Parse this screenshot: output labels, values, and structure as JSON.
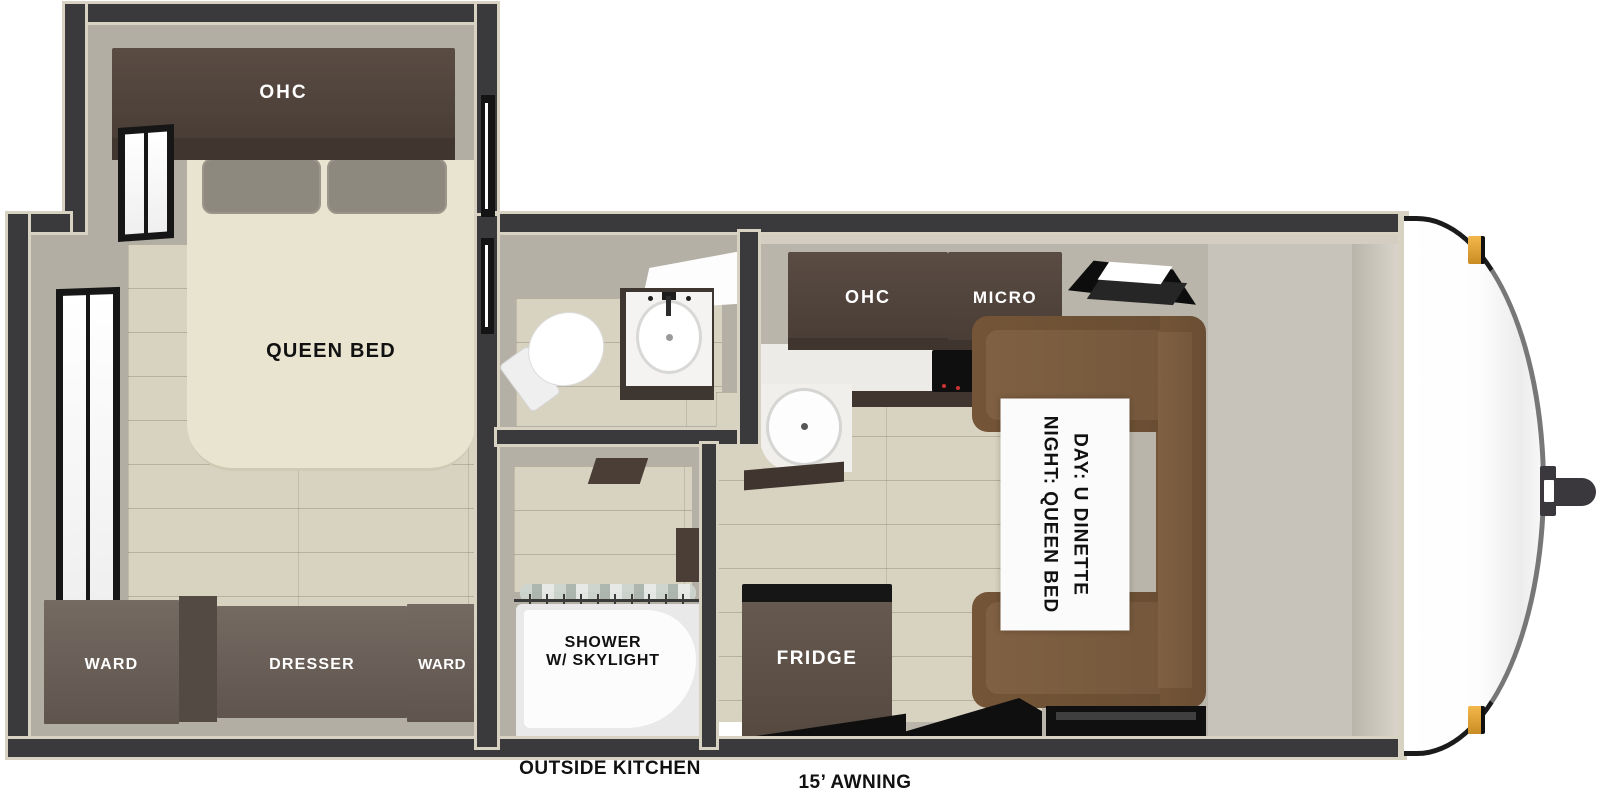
{
  "floorplan": {
    "bedroom": {
      "ohc_label": "OHC",
      "bed_label": "QUEEN BED",
      "ward_left_label": "WARD",
      "dresser_label": "DRESSER",
      "ward_right_label": "WARD"
    },
    "shower": {
      "label_line1": "SHOWER",
      "label_line2": "W/ SKYLIGHT"
    },
    "kitchen": {
      "ohc_label": "OHC",
      "micro_label": "MICRO",
      "fridge_label": "FRIDGE"
    },
    "dinette": {
      "label_line1": "DAY: U DINETTE",
      "label_line2": "NIGHT: QUEEN BED"
    },
    "exterior": {
      "outside_kitchen_label": "OUTSIDE KITCHEN",
      "awning_label": "15’ AWNING"
    },
    "colors": {
      "wall": "#3a3a3c",
      "wall_trim": "#d8d2c3",
      "floor_wood": "#d8d3c1",
      "floor_gray": "#b2aea3",
      "cabinet_dark_brown": "#4e413a",
      "cabinet_gray_brown": "#6c625b",
      "dinette_brown": "#6f5136",
      "bed_cream": "#e9e4cf",
      "marker_light_amber": "#e8a33c",
      "label_dark": "#111111",
      "label_light": "#ffffff"
    }
  }
}
